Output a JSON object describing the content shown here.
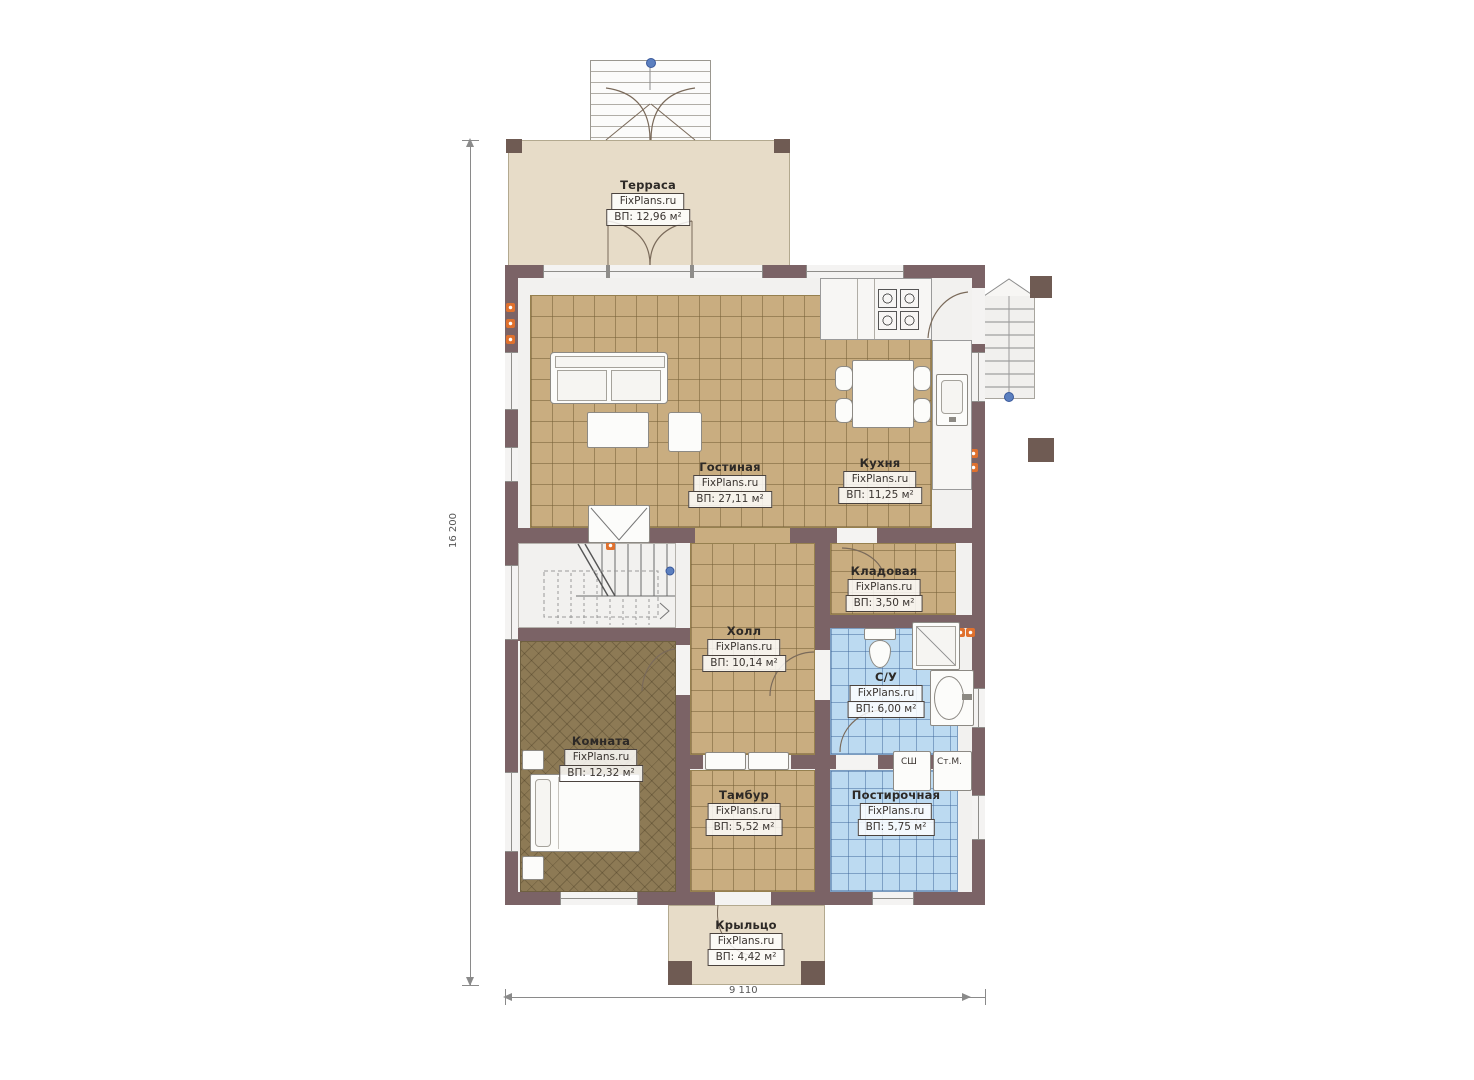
{
  "watermark": "FixPlans.ru",
  "rooms": [
    {
      "name": "Терраса",
      "area": "ВП: 12,96 м²"
    },
    {
      "name": "Гостиная",
      "area": "ВП: 27,11 м²"
    },
    {
      "name": "Кухня",
      "area": "ВП: 11,25 м²"
    },
    {
      "name": "Кладовая",
      "area": "ВП: 3,50 м²"
    },
    {
      "name": "Холл",
      "area": "ВП: 10,14 м²"
    },
    {
      "name": "С/У",
      "area": "ВП: 6,00 м²"
    },
    {
      "name": "Комната",
      "area": "ВП: 12,32 м²"
    },
    {
      "name": "Тамбур",
      "area": "ВП: 5,52 м²"
    },
    {
      "name": "Постирочная",
      "area": "ВП: 5,75 м²"
    },
    {
      "name": "Крыльцо",
      "area": "ВП: 4,42 м²"
    }
  ],
  "appliances": {
    "dryer_label": "СШ",
    "washer_label": "Ст.М."
  },
  "dimensions": {
    "vertical": "16 200",
    "horizontal": "9 110"
  },
  "colors": {
    "wall": "#7b6366",
    "tile_tan": "#c9ad80",
    "tile_blue": "#bcdaf1",
    "deck": "#e7dcc8",
    "carpet": "#8d7a55",
    "outlet": "#e0712e",
    "stair_dot": "#5b7fbf"
  }
}
